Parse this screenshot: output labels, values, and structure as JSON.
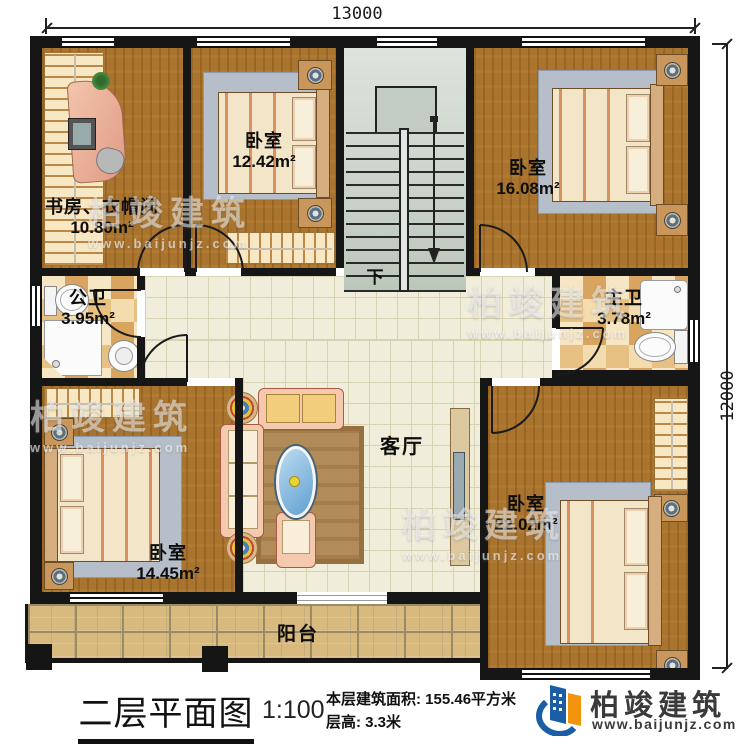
{
  "plan": {
    "title": "二层平面图",
    "scale": "1:100",
    "stats": {
      "area": "本层建筑面积: 155.46平方米",
      "floor_height": "层高: 3.3米"
    },
    "dimensions": {
      "top": "13000",
      "right": "12000"
    },
    "rooms": {
      "study": {
        "name": "书房、衣帽间",
        "area": "10.80m²"
      },
      "bedroom_a": {
        "name": "卧室",
        "area": "12.42m²"
      },
      "bedroom_b": {
        "name": "卧室",
        "area": "16.08m²"
      },
      "public_bath": {
        "name": "公卫",
        "area": "3.95m²"
      },
      "master_bath": {
        "name": "主卫",
        "area": "3.78m²"
      },
      "living": {
        "name": "客厅"
      },
      "bedroom_c": {
        "name": "卧室",
        "area": "14.45m²"
      },
      "bedroom_d": {
        "name": "卧室",
        "area": "22.02m²"
      },
      "balcony": {
        "name": "阳台"
      }
    },
    "stairs": {
      "down": "下"
    }
  },
  "brand": {
    "name": "柏竣建筑",
    "url": "www.baijunjz.com"
  },
  "watermark": {
    "name": "柏竣建筑",
    "url": "www.baijunjz.com"
  },
  "colors": {
    "wall": "#161616",
    "wood": "#a9742e",
    "tile": "#f0edda",
    "accent_blue": "#1b5ea6",
    "accent_orange": "#f2930d"
  }
}
